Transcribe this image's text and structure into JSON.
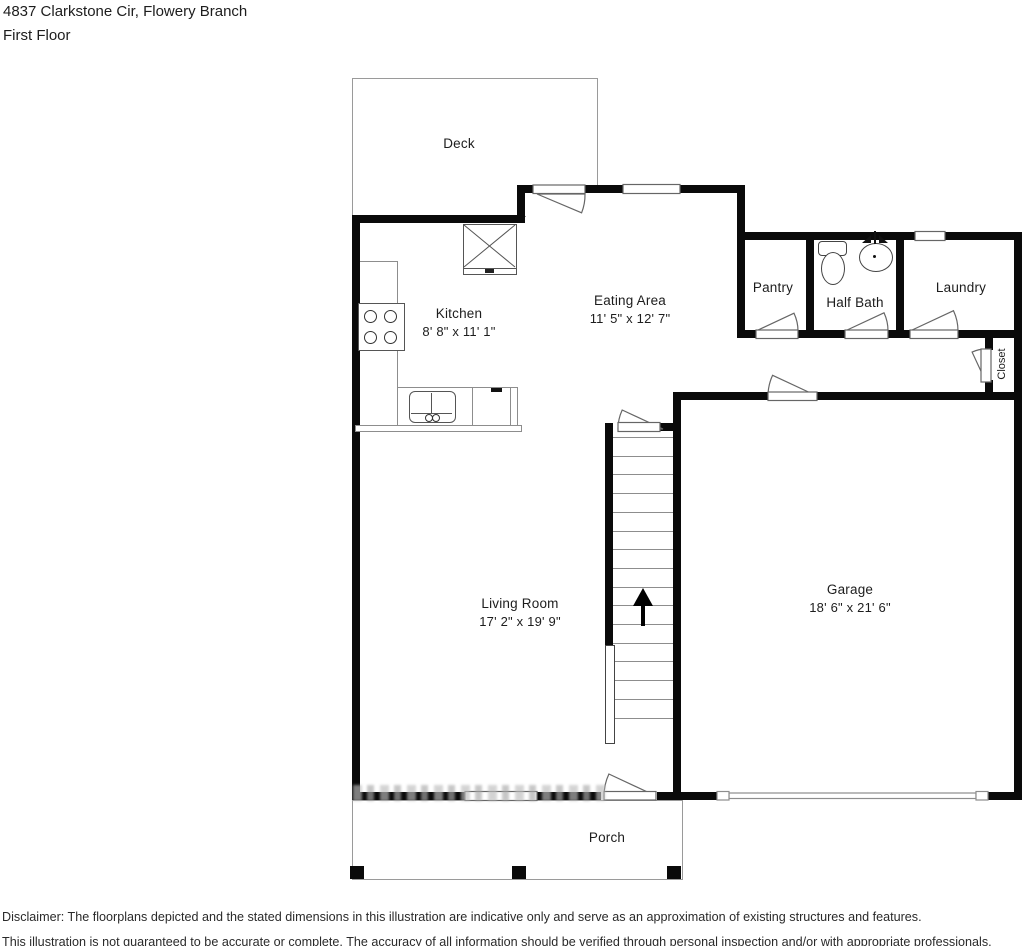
{
  "header": {
    "address": "4837 Clarkstone Cir, Flowery Branch",
    "floor_label": "First Floor"
  },
  "rooms": {
    "deck": {
      "label": "Deck"
    },
    "kitchen": {
      "label": "Kitchen",
      "dims": "8' 8\" x 11' 1\""
    },
    "eating_area": {
      "label": "Eating Area",
      "dims": "11' 5\" x 12' 7\""
    },
    "pantry": {
      "label": "Pantry"
    },
    "half_bath": {
      "label": "Half Bath"
    },
    "laundry": {
      "label": "Laundry"
    },
    "closet": {
      "label": "Closet"
    },
    "living_room": {
      "label": "Living Room",
      "dims": "17' 2\" x 19' 9\""
    },
    "garage": {
      "label": "Garage",
      "dims": "18' 6\" x 21' 6\""
    },
    "porch": {
      "label": "Porch"
    }
  },
  "stairs": {
    "direction": "up"
  },
  "disclaimer": {
    "line1": "Disclaimer: The floorplans depicted and the stated dimensions in this illustration are indicative only and serve as an approximation of existing structures and features.",
    "line2": "This illustration is not guaranteed to be accurate or complete. The accuracy of all information should be verified through personal inspection and/or with appropriate professionals."
  },
  "colors": {
    "wall": "#0a0a0a",
    "outline": "#9a9a9a",
    "fixture_line": "#555555",
    "text": "#1d1d1d"
  }
}
